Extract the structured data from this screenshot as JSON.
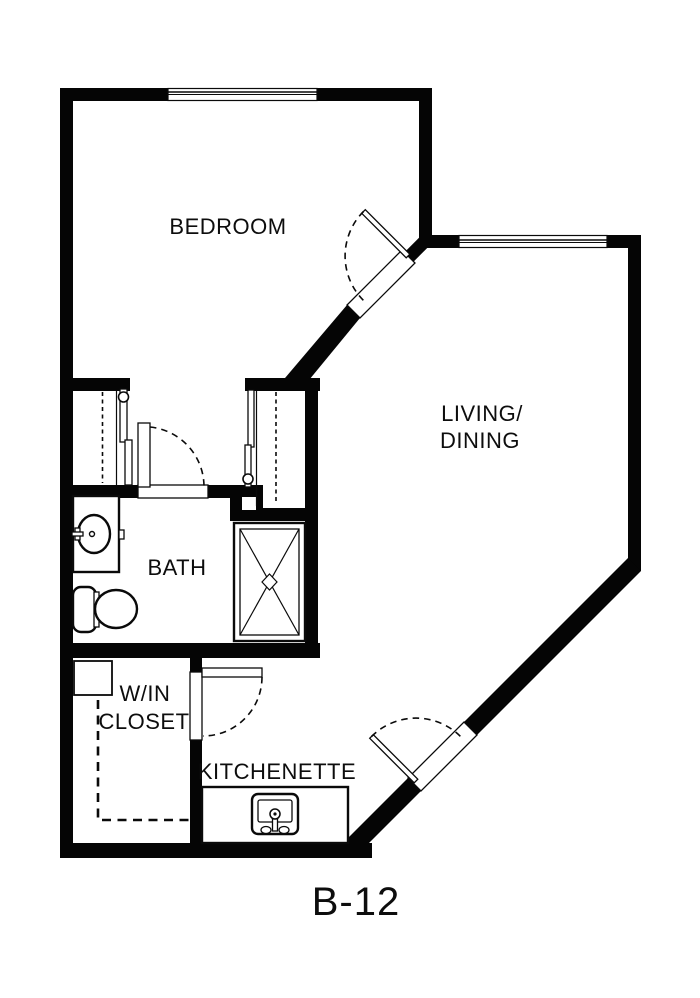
{
  "plan": {
    "unit_label": "B-12",
    "colors": {
      "wall": "#050505",
      "floor": "#ffffff"
    },
    "rooms": {
      "bedroom": {
        "label": "BEDROOM"
      },
      "living_dining": {
        "line1": "LIVING/",
        "line2": "DINING"
      },
      "bath": {
        "label": "BATH"
      },
      "walkin_closet": {
        "line1": "W/IN",
        "line2": "CLOSET"
      },
      "kitchenette": {
        "label": "KITCHENETTE"
      }
    },
    "fixtures": {
      "bath": [
        "vanity-sink",
        "toilet",
        "shower"
      ],
      "kitchenette": [
        "kitchen-sink"
      ]
    },
    "windows": {
      "bedroom": 1,
      "living_dining": 1
    },
    "doors": [
      "bedroom-door",
      "bath-door",
      "walkin-closet-door",
      "entry-door",
      "closet-sliding-doors"
    ]
  }
}
